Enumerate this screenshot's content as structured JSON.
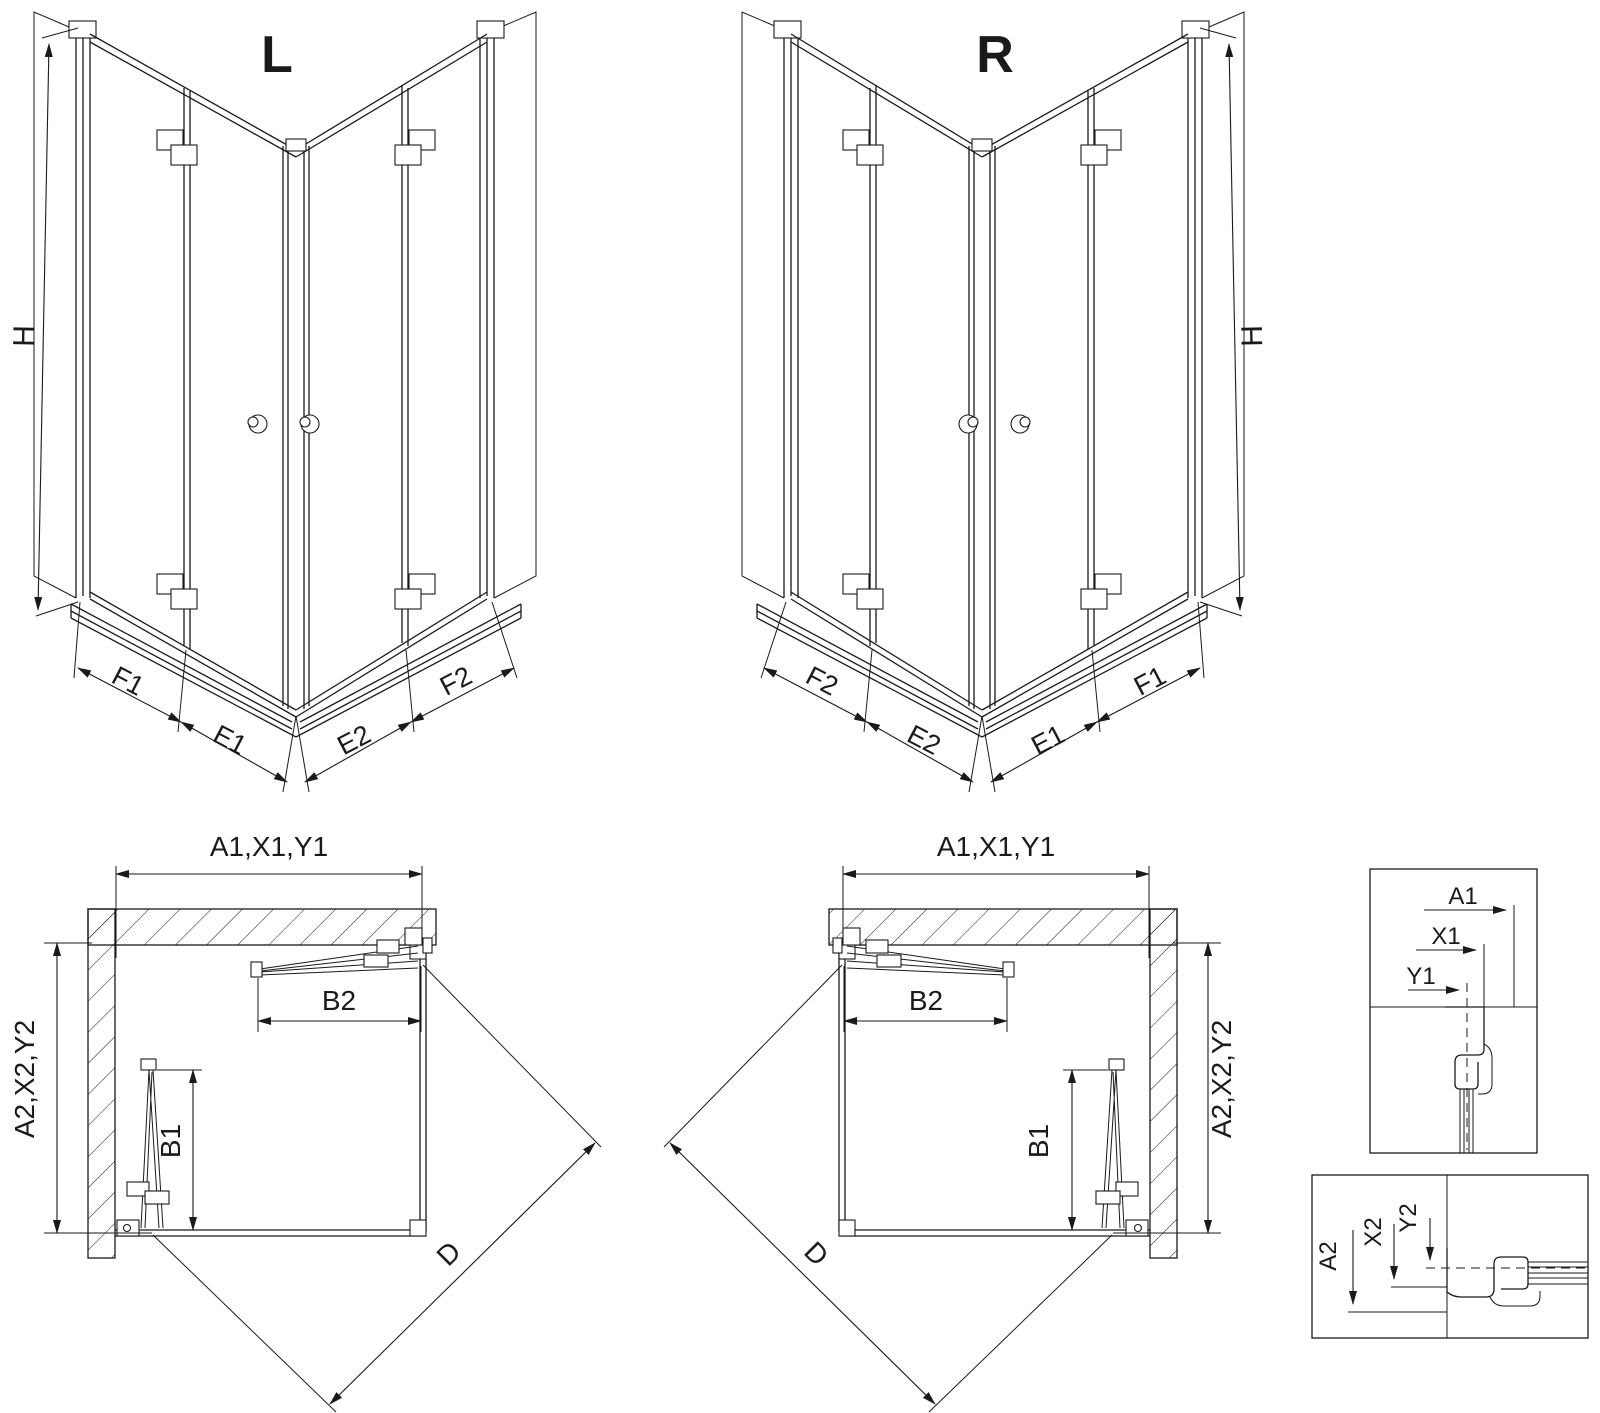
{
  "colors": {
    "line": "#1a1a1a",
    "background": "#ffffff"
  },
  "views": {
    "perspective_left": {
      "title": "L",
      "height_dim": "H",
      "bottom_dims": [
        "F1",
        "E1",
        "E2",
        "F2"
      ]
    },
    "perspective_right": {
      "title": "R",
      "height_dim": "H",
      "bottom_dims": [
        "F2",
        "E2",
        "E1",
        "F1"
      ]
    },
    "plan_left": {
      "width_dim": "A1,X1,Y1",
      "depth_dim": "A2,X2,Y2",
      "door_top_dim": "B2",
      "door_side_dim": "B1",
      "diagonal_dim": "D"
    },
    "plan_right": {
      "width_dim": "A1,X1,Y1",
      "depth_dim": "A2,X2,Y2",
      "door_top_dim": "B2",
      "door_side_dim": "B1",
      "diagonal_dim": "D"
    },
    "detail_width_refs": {
      "dims": [
        "A1",
        "X1",
        "Y1"
      ]
    },
    "detail_depth_refs": {
      "dims": [
        "A2",
        "X2",
        "Y2"
      ]
    }
  }
}
